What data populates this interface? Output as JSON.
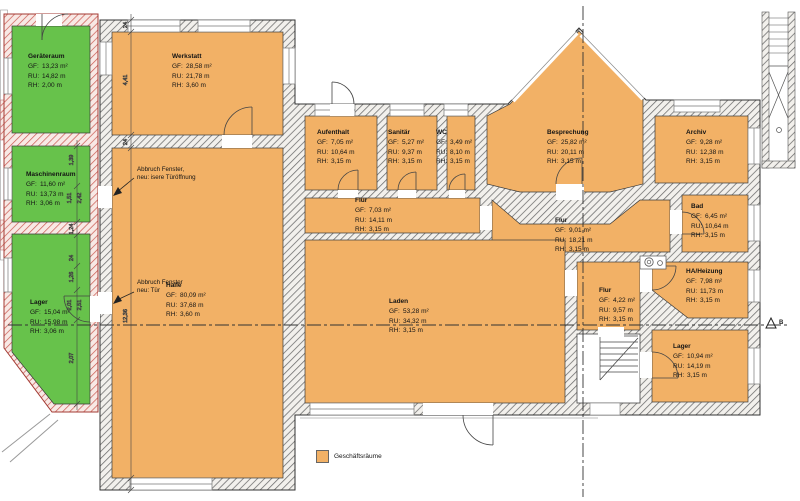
{
  "title": "Grundriss Erdgeschoss",
  "legend": {
    "label": "Geschäftsräume",
    "swatch_color": "#F2B166"
  },
  "colors": {
    "business_room": "#F2B166",
    "green_room": "#67C24B",
    "wall_hatch_line": "#6a6a6a",
    "red_wall_hatch_line": "#c9574f"
  },
  "labels": {
    "gf": "GF:",
    "ru": "RU:",
    "rh": "RH:"
  },
  "rooms": [
    {
      "id": "geraeteraum",
      "name": "Geräteraum",
      "gf": "13,23 m²",
      "ru": "14,82 m",
      "rh": "2,00 m",
      "type": "green"
    },
    {
      "id": "maschinenraum",
      "name": "Maschinenraum",
      "gf": "11,60 m²",
      "ru": "13,73 m",
      "rh": "3,06 m",
      "type": "green"
    },
    {
      "id": "lager-west",
      "name": "Lager",
      "gf": "15,04 m²",
      "ru": "15,98 m",
      "rh": "3,06 m",
      "type": "green"
    },
    {
      "id": "werkstatt",
      "name": "Werkstatt",
      "gf": "28,58 m²",
      "ru": "21,78 m",
      "rh": "3,60 m",
      "type": "business"
    },
    {
      "id": "halle",
      "name": "Halle",
      "gf": "80,09 m²",
      "ru": "37,68 m",
      "rh": "3,60 m",
      "type": "business"
    },
    {
      "id": "aufenthalt",
      "name": "Aufenthalt",
      "gf": "7,05 m²",
      "ru": "10,64 m",
      "rh": "3,15 m",
      "type": "business"
    },
    {
      "id": "sanitaer",
      "name": "Sanitär",
      "gf": "5,27 m²",
      "ru": "9,37 m",
      "rh": "3,15 m",
      "type": "business"
    },
    {
      "id": "wc",
      "name": "WC",
      "gf": "3,49 m²",
      "ru": "8,10 m",
      "rh": "3,15 m",
      "type": "business"
    },
    {
      "id": "flur-west",
      "name": "Flur",
      "gf": "7,03 m²",
      "ru": "14,11 m",
      "rh": "3,15 m",
      "type": "business"
    },
    {
      "id": "besprechung",
      "name": "Besprechung",
      "gf": "25,82 m²",
      "ru": "20,11 m",
      "rh": "3,15 m",
      "type": "business"
    },
    {
      "id": "archiv",
      "name": "Archiv",
      "gf": "9,28 m²",
      "ru": "12,38 m",
      "rh": "3,15 m",
      "type": "business"
    },
    {
      "id": "flur-mitte",
      "name": "Flur",
      "gf": "9,01 m²",
      "ru": "18,21 m",
      "rh": "3,15 m",
      "type": "business"
    },
    {
      "id": "bad",
      "name": "Bad",
      "gf": "6,45 m²",
      "ru": "10,64 m",
      "rh": "3,15 m",
      "type": "business"
    },
    {
      "id": "laden",
      "name": "Laden",
      "gf": "53,28 m²",
      "ru": "34,32 m",
      "rh": "3,15 m",
      "type": "business"
    },
    {
      "id": "flur-ost",
      "name": "Flur",
      "gf": "4,22 m²",
      "ru": "9,57 m",
      "rh": "3,15 m",
      "type": "business"
    },
    {
      "id": "ha-heizung",
      "name": "HA/Heizung",
      "gf": "7,98 m²",
      "ru": "11,73 m",
      "rh": "3,15 m",
      "type": "business"
    },
    {
      "id": "lager-ost",
      "name": "Lager",
      "gf": "10,94 m²",
      "ru": "14,19 m",
      "rh": "3,15 m",
      "type": "business"
    }
  ],
  "annotations": [
    {
      "line1": "Abbruch Fenster,",
      "line2": "neu: isere Türöffnung"
    },
    {
      "line1": "Abbruch Fenster",
      "line2": "neu:  Tür"
    }
  ],
  "dimensions": {
    "chain_a": [
      "24",
      "4,41",
      "24",
      "12,36"
    ],
    "chain_b": [
      "1,39",
      "1,51",
      "2,42",
      "1,24",
      "24",
      "1,26",
      "2,01",
      "2,51",
      "2,07"
    ]
  },
  "section_marker": "B"
}
